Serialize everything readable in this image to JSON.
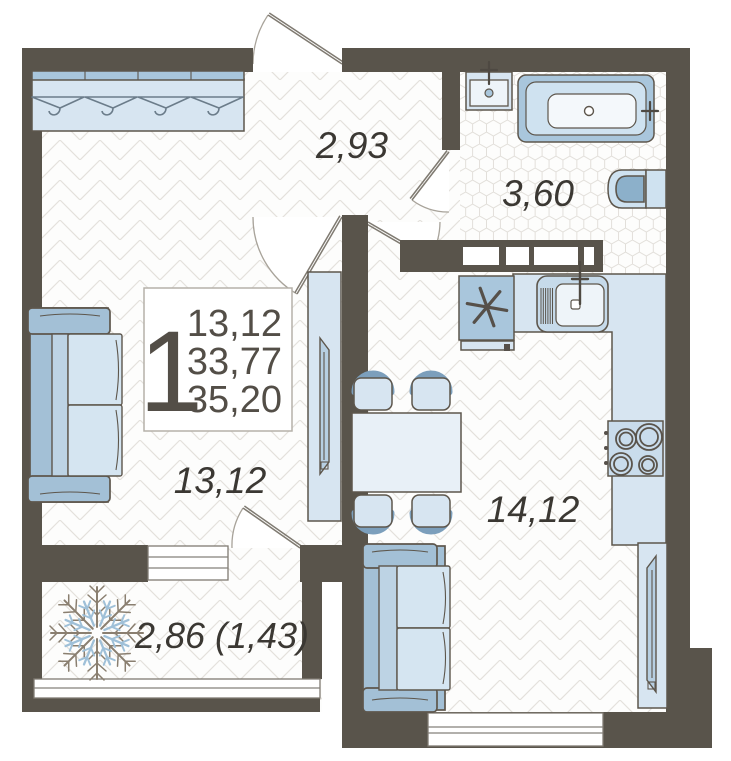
{
  "plan": {
    "title": "one-room apartment floor plan",
    "info_box": {
      "rooms_count": "1",
      "living_area": "13,12",
      "apartment_area": "33,77",
      "total_area": "35,20"
    },
    "rooms": {
      "hallway": {
        "label": "2,93"
      },
      "bathroom": {
        "label": "3,60"
      },
      "living": {
        "label": "13,12"
      },
      "kitchen": {
        "label": "14,12"
      },
      "balcony": {
        "label": "2,86 (1,43)"
      }
    },
    "icons": {
      "snowflake": "unheated balcony marker",
      "asterisk": "fridge marker",
      "hanger": "wardrobe hangers"
    },
    "colors": {
      "wall": "#59544b",
      "furniture_light": "#d7e5f1",
      "furniture_mid": "#a9c6dc",
      "furniture_accent": "#8cb0ca",
      "outline": "#5d564c",
      "floor_line": "#e4e1dc",
      "text": "#3b3833"
    }
  }
}
